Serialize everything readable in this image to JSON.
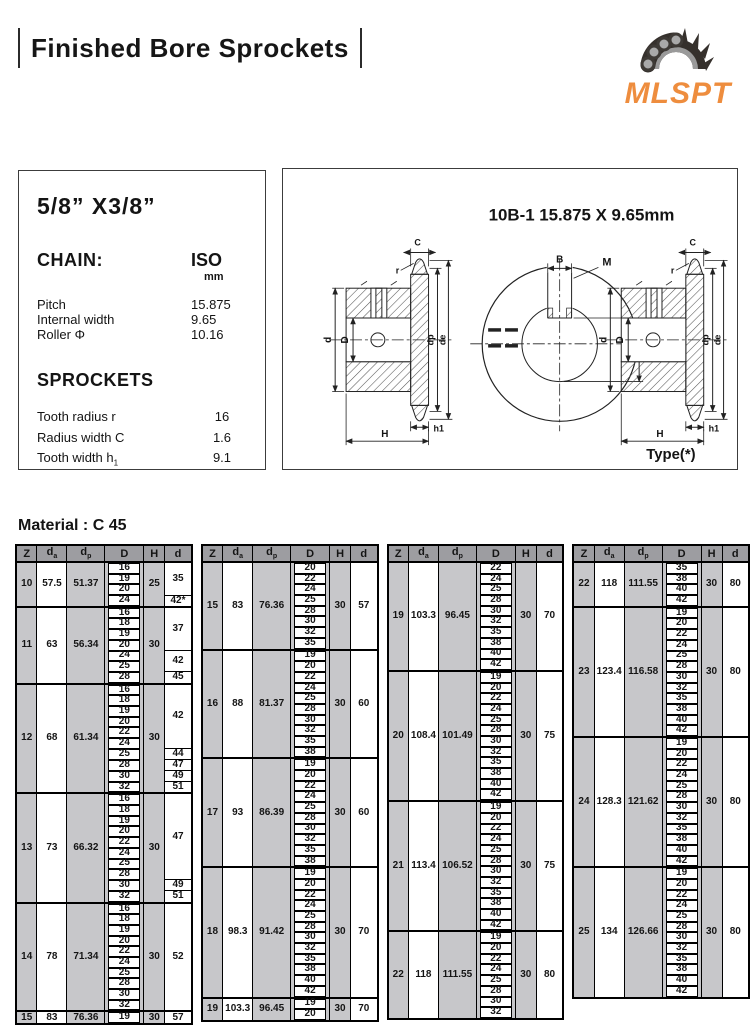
{
  "header": {
    "title": "Finished Bore Sprockets",
    "logo_text": "MLSPT"
  },
  "spec_panel": {
    "size_title": "5/8” X3/8”",
    "chain_label": "CHAIN:",
    "chain_standard": "ISO",
    "chain_unit": "mm",
    "chain_rows": [
      {
        "label": "Pitch",
        "value": "15.875"
      },
      {
        "label": "Internal width",
        "value": "9.65"
      },
      {
        "label": "Roller Φ",
        "value": "10.16"
      }
    ],
    "sprockets_label": "SPROCKETS",
    "sprocket_rows": [
      {
        "label": "Tooth radius r",
        "value": "16"
      },
      {
        "label": "Radius width C",
        "value": "1.6"
      },
      {
        "label": "Tooth width h",
        "label_sub": "1",
        "value": "9.1"
      }
    ]
  },
  "drawing": {
    "title": "10B-1  15.875 X 9.65mm",
    "type_label": "Type(*)",
    "dim_labels": {
      "C": "C",
      "r": "r",
      "d": "d",
      "D": "D",
      "dp": "dp",
      "de": "de",
      "h1": "h1",
      "H": "H",
      "B": "B",
      "M": "M",
      "T": "T"
    }
  },
  "material_label": "Material : C 45",
  "table_headers": [
    {
      "main": "Z"
    },
    {
      "main": "d",
      "sub": "a"
    },
    {
      "main": "d",
      "sub": "p"
    },
    {
      "main": "D"
    },
    {
      "main": "H"
    },
    {
      "main": "d"
    }
  ],
  "tables": [
    {
      "groups": [
        {
          "z": "10",
          "da": "57.5",
          "dp": "51.37",
          "h": "25",
          "sub": [
            {
              "D": [
                "16",
                "19",
                "20"
              ],
              "d": "35"
            },
            {
              "D": [
                "24"
              ],
              "d": "42*"
            }
          ]
        },
        {
          "z": "11",
          "da": "63",
          "dp": "56.34",
          "h": "30",
          "sub": [
            {
              "D": [
                "16",
                "18",
                "19",
                "20"
              ],
              "d": "37"
            },
            {
              "D": [
                "24",
                "25"
              ],
              "d": "42"
            },
            {
              "D": [
                "28"
              ],
              "d": "45"
            }
          ]
        },
        {
          "z": "12",
          "da": "68",
          "dp": "61.34",
          "h": "30",
          "sub": [
            {
              "D": [
                "16",
                "18",
                "19",
                "20",
                "22",
                "24"
              ],
              "d": "42"
            },
            {
              "D": [
                "25"
              ],
              "d": "44"
            },
            {
              "D": [
                "28"
              ],
              "d": "47"
            },
            {
              "D": [
                "30"
              ],
              "d": "49"
            },
            {
              "D": [
                "32"
              ],
              "d": "51"
            }
          ]
        },
        {
          "z": "13",
          "da": "73",
          "dp": "66.32",
          "h": "30",
          "sub": [
            {
              "D": [
                "16",
                "18",
                "19",
                "20",
                "22",
                "24",
                "25",
                "28"
              ],
              "d": "47"
            },
            {
              "D": [
                "30"
              ],
              "d": "49"
            },
            {
              "D": [
                "32"
              ],
              "d": "51"
            }
          ]
        },
        {
          "z": "14",
          "da": "78",
          "dp": "71.34",
          "h": "30",
          "sub": [
            {
              "D": [
                "16",
                "18",
                "19",
                "20",
                "22",
                "24",
                "25",
                "28",
                "30",
                "32"
              ],
              "d": "52"
            }
          ]
        },
        {
          "z": "15",
          "da": "83",
          "dp": "76.36",
          "h": "30",
          "sub": [
            {
              "D": [
                "19"
              ],
              "d": "57"
            }
          ]
        }
      ]
    },
    {
      "groups": [
        {
          "z": "15",
          "da": "83",
          "dp": "76.36",
          "h": "30",
          "sub": [
            {
              "D": [
                "20",
                "22",
                "24",
                "25",
                "28",
                "30",
                "32",
                "35"
              ],
              "d": "57"
            }
          ]
        },
        {
          "z": "16",
          "da": "88",
          "dp": "81.37",
          "h": "30",
          "sub": [
            {
              "D": [
                "19",
                "20",
                "22",
                "24",
                "25",
                "28",
                "30",
                "32",
                "35",
                "38"
              ],
              "d": "60"
            }
          ]
        },
        {
          "z": "17",
          "da": "93",
          "dp": "86.39",
          "h": "30",
          "sub": [
            {
              "D": [
                "19",
                "20",
                "22",
                "24",
                "25",
                "28",
                "30",
                "32",
                "35",
                "38"
              ],
              "d": "60"
            }
          ]
        },
        {
          "z": "18",
          "da": "98.3",
          "dp": "91.42",
          "h": "30",
          "sub": [
            {
              "D": [
                "19",
                "20",
                "22",
                "24",
                "25",
                "28",
                "30",
                "32",
                "35",
                "38",
                "40",
                "42"
              ],
              "d": "70"
            }
          ]
        },
        {
          "z": "19",
          "da": "103.3",
          "dp": "96.45",
          "h": "30",
          "sub": [
            {
              "D": [
                "19",
                "20"
              ],
              "d": "70"
            }
          ]
        }
      ]
    },
    {
      "groups": [
        {
          "z": "19",
          "da": "103.3",
          "dp": "96.45",
          "h": "30",
          "sub": [
            {
              "D": [
                "22",
                "24",
                "25",
                "28",
                "30",
                "32",
                "35",
                "38",
                "40",
                "42"
              ],
              "d": "70"
            }
          ]
        },
        {
          "z": "20",
          "da": "108.4",
          "dp": "101.49",
          "h": "30",
          "sub": [
            {
              "D": [
                "19",
                "20",
                "22",
                "24",
                "25",
                "28",
                "30",
                "32",
                "35",
                "38",
                "40",
                "42"
              ],
              "d": "75"
            }
          ]
        },
        {
          "z": "21",
          "da": "113.4",
          "dp": "106.52",
          "h": "30",
          "sub": [
            {
              "D": [
                "19",
                "20",
                "22",
                "24",
                "25",
                "28",
                "30",
                "32",
                "35",
                "38",
                "40",
                "42"
              ],
              "d": "75"
            }
          ]
        },
        {
          "z": "22",
          "da": "118",
          "dp": "111.55",
          "h": "30",
          "sub": [
            {
              "D": [
                "19",
                "20",
                "22",
                "24",
                "25",
                "28",
                "30",
                "32"
              ],
              "d": "80"
            }
          ]
        }
      ]
    },
    {
      "groups": [
        {
          "z": "22",
          "da": "118",
          "dp": "111.55",
          "h": "30",
          "sub": [
            {
              "D": [
                "35",
                "38",
                "40",
                "42"
              ],
              "d": "80"
            }
          ]
        },
        {
          "z": "23",
          "da": "123.4",
          "dp": "116.58",
          "h": "30",
          "sub": [
            {
              "D": [
                "19",
                "20",
                "22",
                "24",
                "25",
                "28",
                "30",
                "32",
                "35",
                "38",
                "40",
                "42"
              ],
              "d": "80"
            }
          ]
        },
        {
          "z": "24",
          "da": "128.3",
          "dp": "121.62",
          "h": "30",
          "sub": [
            {
              "D": [
                "19",
                "20",
                "22",
                "24",
                "25",
                "28",
                "30",
                "32",
                "35",
                "38",
                "40",
                "42"
              ],
              "d": "80"
            }
          ]
        },
        {
          "z": "25",
          "da": "134",
          "dp": "126.66",
          "h": "30",
          "sub": [
            {
              "D": [
                "19",
                "20",
                "22",
                "24",
                "25",
                "28",
                "30",
                "32",
                "35",
                "38",
                "40",
                "42"
              ],
              "d": "80"
            }
          ]
        }
      ]
    }
  ]
}
